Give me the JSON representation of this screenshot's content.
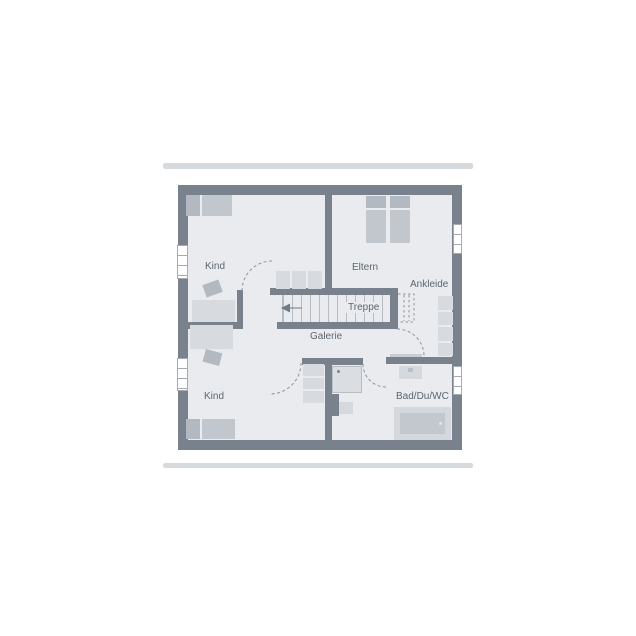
{
  "floorplan": {
    "labels": {
      "room_kind_top": "Kind",
      "room_eltern": "Eltern",
      "area_ankleide": "Ankleide",
      "stairs": "Treppe",
      "area_galerie": "Galerie",
      "room_kind_bottom": "Kind",
      "room_bad": "Bad/Du/WC"
    },
    "colors": {
      "wall": "#78818c",
      "floor": "#e9ebee",
      "flight": "#d7dade",
      "fmid": "#c2c7cd",
      "fdark": "#b3b9c1",
      "fixture": "#d5d8dc",
      "tread": "#b6bcc3",
      "arc": "#8d949e",
      "label": "#5d6670",
      "bar": "#d7dadd",
      "winframe": "#a3aab2",
      "pagebg": "#ffffff"
    }
  }
}
